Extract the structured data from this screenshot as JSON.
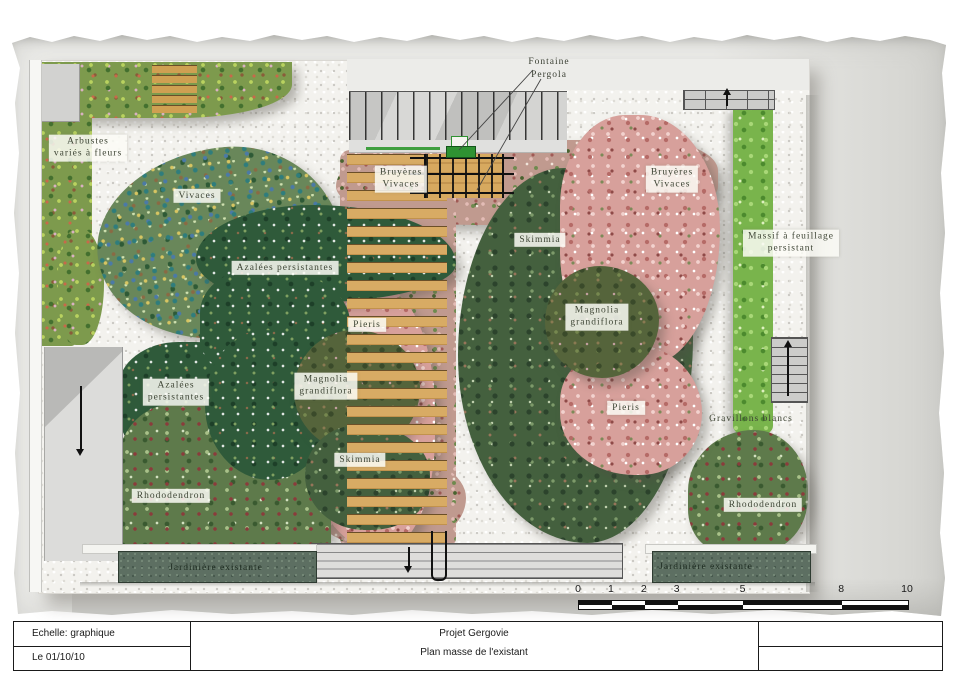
{
  "title_block": {
    "scale_label": "Echelle: graphique",
    "date_label": "Le 01/10/10",
    "project_title": "Projet Gergovie",
    "drawing_title": "Plan masse de l'existant"
  },
  "callouts": {
    "fountain": "Fontaine",
    "pergola": "Pergola"
  },
  "plant_labels": [
    {
      "id": "arbustes-varies",
      "text": "Arbustes\nvariés à fleurs",
      "x": 88,
      "y": 148,
      "boxed": true
    },
    {
      "id": "vivaces",
      "text": "Vivaces",
      "x": 197,
      "y": 196,
      "boxed": true
    },
    {
      "id": "azalees-persistantes-top",
      "text": "Azalées persistantes",
      "x": 285,
      "y": 268,
      "boxed": true
    },
    {
      "id": "bruyeres-vivaces-left",
      "text": "Bruyères\nVivaces",
      "x": 401,
      "y": 179,
      "boxed": true
    },
    {
      "id": "bruyeres-vivaces-right",
      "text": "Bruyères\nVivaces",
      "x": 672,
      "y": 179,
      "boxed": true
    },
    {
      "id": "skimmia-right",
      "text": "Skimmia",
      "x": 540,
      "y": 240,
      "boxed": true
    },
    {
      "id": "magnolia-grandiflora-right",
      "text": "Magnolia\ngrandiflora",
      "x": 597,
      "y": 317,
      "boxed": true
    },
    {
      "id": "massif-feuillage-persistant",
      "text": "Massif à feuillage\npersistant",
      "x": 791,
      "y": 243,
      "boxed": true
    },
    {
      "id": "pieris-left",
      "text": "Pieris",
      "x": 367,
      "y": 325,
      "boxed": true
    },
    {
      "id": "magnolia-grandiflora-left",
      "text": "Magnolia\ngrandiflora",
      "x": 326,
      "y": 386,
      "boxed": true
    },
    {
      "id": "azalees-persistantes-bottom",
      "text": "Azalées\npersistantes",
      "x": 176,
      "y": 392,
      "boxed": true
    },
    {
      "id": "skimmia-left",
      "text": "Skimmia",
      "x": 360,
      "y": 460,
      "boxed": true
    },
    {
      "id": "pieris-right",
      "text": "Pieris",
      "x": 626,
      "y": 408,
      "boxed": true
    },
    {
      "id": "gravillons-blancs",
      "text": "Gravillons blancs",
      "x": 751,
      "y": 419,
      "boxed": false
    },
    {
      "id": "rhododendron-left",
      "text": "Rhododendron",
      "x": 171,
      "y": 496,
      "boxed": true
    },
    {
      "id": "rhododendron-right",
      "text": "Rhododendron",
      "x": 763,
      "y": 505,
      "boxed": true
    },
    {
      "id": "jardiniere-left",
      "text": "Jardinière existante",
      "x": 216,
      "y": 568,
      "boxed": false,
      "dark": true
    },
    {
      "id": "jardiniere-right",
      "text": "Jardinière existante",
      "x": 706,
      "y": 567,
      "boxed": false,
      "dark": true
    }
  ],
  "scale_bar": {
    "ticks": [
      {
        "label": "0",
        "pct": 0
      },
      {
        "label": "1",
        "pct": 10
      },
      {
        "label": "2",
        "pct": 20
      },
      {
        "label": "3",
        "pct": 30
      },
      {
        "label": "5",
        "pct": 50
      },
      {
        "label": "8",
        "pct": 80
      },
      {
        "label": "10",
        "pct": 100
      }
    ]
  },
  "colors": {
    "fountain_green": "#2f9232",
    "wood": "#d8ab64",
    "gravel": "#f3f2ee",
    "hedge_green": "#79b44c",
    "planter_green": "#5d6f62"
  }
}
